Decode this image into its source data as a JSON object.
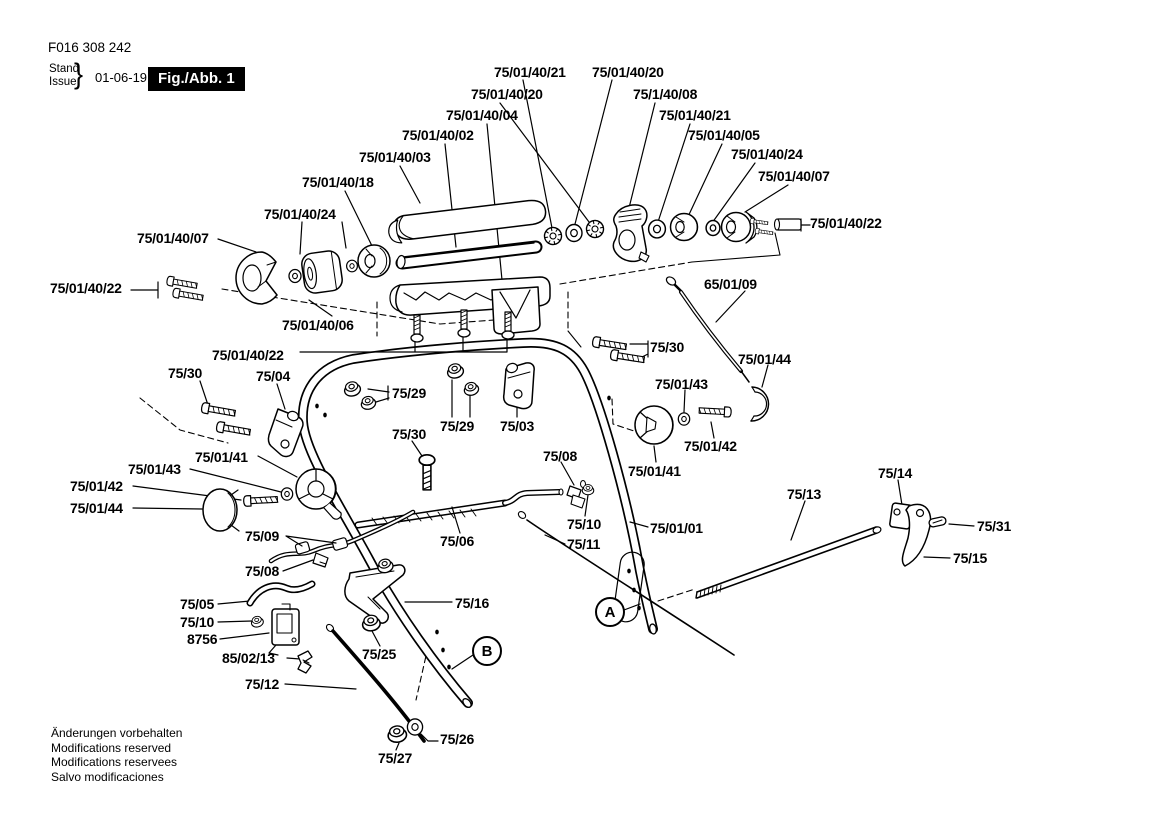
{
  "colors": {
    "ink": "#000000",
    "paper": "#ffffff"
  },
  "header": {
    "part_number": "F016 308 242",
    "stand_label": "Stand",
    "issue_label": "Issue",
    "brace": "}",
    "date": "01-06-19",
    "figure_label": "Fig./Abb. 1"
  },
  "footer": {
    "lines": [
      "Änderungen vorbehalten",
      "Modifications reserved",
      "Modifications reservees",
      "Salvo modificaciones"
    ]
  },
  "diagram": {
    "view_markers": [
      {
        "letter": "A",
        "cx": 610,
        "cy": 612
      },
      {
        "letter": "B",
        "cx": 487,
        "cy": 651
      }
    ],
    "part_labels": [
      {
        "text": "75/01/40/21",
        "x": 494,
        "y": 65
      },
      {
        "text": "75/01/40/20",
        "x": 592,
        "y": 65
      },
      {
        "text": "75/01/40/20",
        "x": 471,
        "y": 87
      },
      {
        "text": "75/1/40/08",
        "x": 633,
        "y": 87
      },
      {
        "text": "75/01/40/04",
        "x": 446,
        "y": 108
      },
      {
        "text": "75/01/40/21",
        "x": 659,
        "y": 108
      },
      {
        "text": "75/01/40/02",
        "x": 402,
        "y": 128
      },
      {
        "text": "75/01/40/05",
        "x": 688,
        "y": 128
      },
      {
        "text": "75/01/40/03",
        "x": 359,
        "y": 150
      },
      {
        "text": "75/01/40/24",
        "x": 731,
        "y": 147
      },
      {
        "text": "75/01/40/18",
        "x": 302,
        "y": 175
      },
      {
        "text": "75/01/40/07",
        "x": 758,
        "y": 169
      },
      {
        "text": "75/01/40/24",
        "x": 264,
        "y": 207
      },
      {
        "text": "75/01/40/07",
        "x": 137,
        "y": 231
      },
      {
        "text": "75/01/40/22",
        "x": 810,
        "y": 216
      },
      {
        "text": "75/01/40/22",
        "x": 50,
        "y": 281
      },
      {
        "text": "65/01/09",
        "x": 704,
        "y": 277
      },
      {
        "text": "75/01/40/06",
        "x": 282,
        "y": 318
      },
      {
        "text": "75/01/40/22",
        "x": 212,
        "y": 348
      },
      {
        "text": "75/30",
        "x": 168,
        "y": 366
      },
      {
        "text": "75/04",
        "x": 256,
        "y": 369
      },
      {
        "text": "75/29",
        "x": 392,
        "y": 386
      },
      {
        "text": "75/30",
        "x": 650,
        "y": 340
      },
      {
        "text": "75/01/44",
        "x": 738,
        "y": 352
      },
      {
        "text": "75/29",
        "x": 440,
        "y": 419
      },
      {
        "text": "75/03",
        "x": 500,
        "y": 419
      },
      {
        "text": "75/01/43",
        "x": 655,
        "y": 377
      },
      {
        "text": "75/30",
        "x": 392,
        "y": 427
      },
      {
        "text": "75/08",
        "x": 543,
        "y": 449
      },
      {
        "text": "75/01/41",
        "x": 195,
        "y": 450
      },
      {
        "text": "75/01/43",
        "x": 128,
        "y": 462
      },
      {
        "text": "75/01/42",
        "x": 70,
        "y": 479
      },
      {
        "text": "75/01/44",
        "x": 70,
        "y": 501
      },
      {
        "text": "75/01/42",
        "x": 684,
        "y": 439
      },
      {
        "text": "75/01/41",
        "x": 628,
        "y": 464
      },
      {
        "text": "75/14",
        "x": 878,
        "y": 466
      },
      {
        "text": "75/13",
        "x": 787,
        "y": 487
      },
      {
        "text": "75/09",
        "x": 245,
        "y": 529
      },
      {
        "text": "75/06",
        "x": 440,
        "y": 534
      },
      {
        "text": "75/10",
        "x": 567,
        "y": 517
      },
      {
        "text": "75/01/01",
        "x": 650,
        "y": 521
      },
      {
        "text": "75/31",
        "x": 977,
        "y": 519
      },
      {
        "text": "75/11",
        "x": 567,
        "y": 537
      },
      {
        "text": "75/15",
        "x": 953,
        "y": 551
      },
      {
        "text": "75/08",
        "x": 245,
        "y": 564
      },
      {
        "text": "75/05",
        "x": 180,
        "y": 597
      },
      {
        "text": "75/10",
        "x": 180,
        "y": 615
      },
      {
        "text": "8756",
        "x": 187,
        "y": 632
      },
      {
        "text": "75/16",
        "x": 455,
        "y": 596
      },
      {
        "text": "85/02/13",
        "x": 222,
        "y": 651
      },
      {
        "text": "75/25",
        "x": 362,
        "y": 647
      },
      {
        "text": "75/12",
        "x": 245,
        "y": 677
      },
      {
        "text": "75/26",
        "x": 440,
        "y": 732
      },
      {
        "text": "75/27",
        "x": 378,
        "y": 751
      }
    ]
  }
}
